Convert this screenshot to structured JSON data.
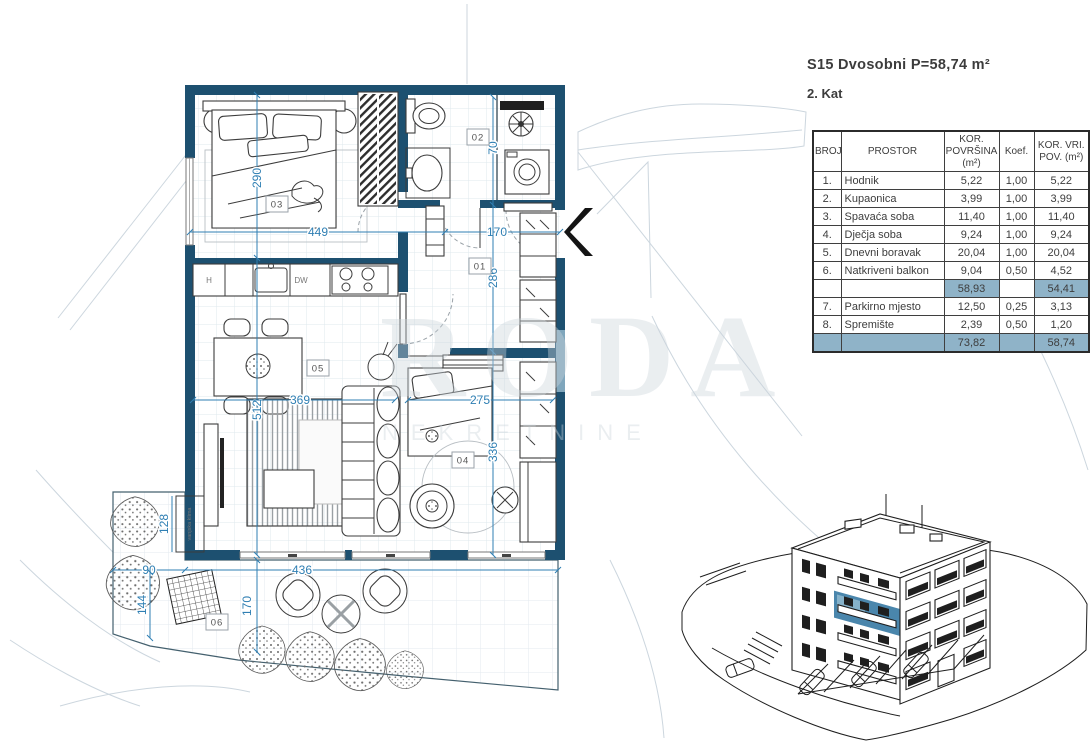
{
  "title": {
    "line1": "S15 Dvosobni  P=58,74 m²",
    "line2": "2. Kat"
  },
  "table": {
    "headers": {
      "broj": "BROJ",
      "prostor": "PROSTOR",
      "povrsina": "KOR. POVRŠINA (m²)",
      "koef": "Koef.",
      "pov": "KOR. VRI. POV. (m²)"
    },
    "rows": [
      {
        "broj": "1.",
        "prostor": "Hodnik",
        "povrsina": "5,22",
        "koef": "1,00",
        "pov": "5,22"
      },
      {
        "broj": "2.",
        "prostor": "Kupaonica",
        "povrsina": "3,99",
        "koef": "1,00",
        "pov": "3,99"
      },
      {
        "broj": "3.",
        "prostor": "Spavaća soba",
        "povrsina": "11,40",
        "koef": "1,00",
        "pov": "11,40"
      },
      {
        "broj": "4.",
        "prostor": "Dječja soba",
        "povrsina": "9,24",
        "koef": "1,00",
        "pov": "9,24"
      },
      {
        "broj": "5.",
        "prostor": "Dnevni boravak",
        "povrsina": "20,04",
        "koef": "1,00",
        "pov": "20,04"
      },
      {
        "broj": "6.",
        "prostor": "Natkriveni balkon",
        "povrsina": "9,04",
        "koef": "0,50",
        "pov": "4,52"
      }
    ],
    "subtotal": {
      "povrsina": "58,93",
      "pov": "54,41"
    },
    "rows2": [
      {
        "broj": "7.",
        "prostor": "Parkirno mjesto",
        "povrsina": "12,50",
        "koef": "0,25",
        "pov": "3,13"
      },
      {
        "broj": "8.",
        "prostor": "Spremište",
        "povrsina": "2,39",
        "koef": "0,50",
        "pov": "1,20"
      }
    ],
    "total": {
      "povrsina": "73,82",
      "pov": "58,74"
    }
  },
  "plan": {
    "rooms": {
      "r01": "01",
      "r02": "02",
      "r03": "03",
      "r04": "04",
      "r05": "05",
      "r06": "06"
    },
    "dims": {
      "d449": "449",
      "d170top": "170",
      "d290": "290",
      "d70": "70",
      "d286": "286",
      "d369": "369",
      "d275": "275",
      "d512": "512",
      "d336": "336",
      "d436": "436",
      "d90": "90",
      "d170terrace": "170",
      "d144": "144",
      "d128": "128"
    },
    "kitchen": {
      "hood": "H",
      "dishwasher": "DW"
    },
    "ac_unit_label": "vanjska klima"
  },
  "watermark": {
    "big": "RODA",
    "small": "NEKRETNINE"
  },
  "colors": {
    "wall": "#1d5070",
    "dimension": "#2f7fb3",
    "table_highlight": "#8fb3c8",
    "unit_highlight": "#4a86ac"
  }
}
